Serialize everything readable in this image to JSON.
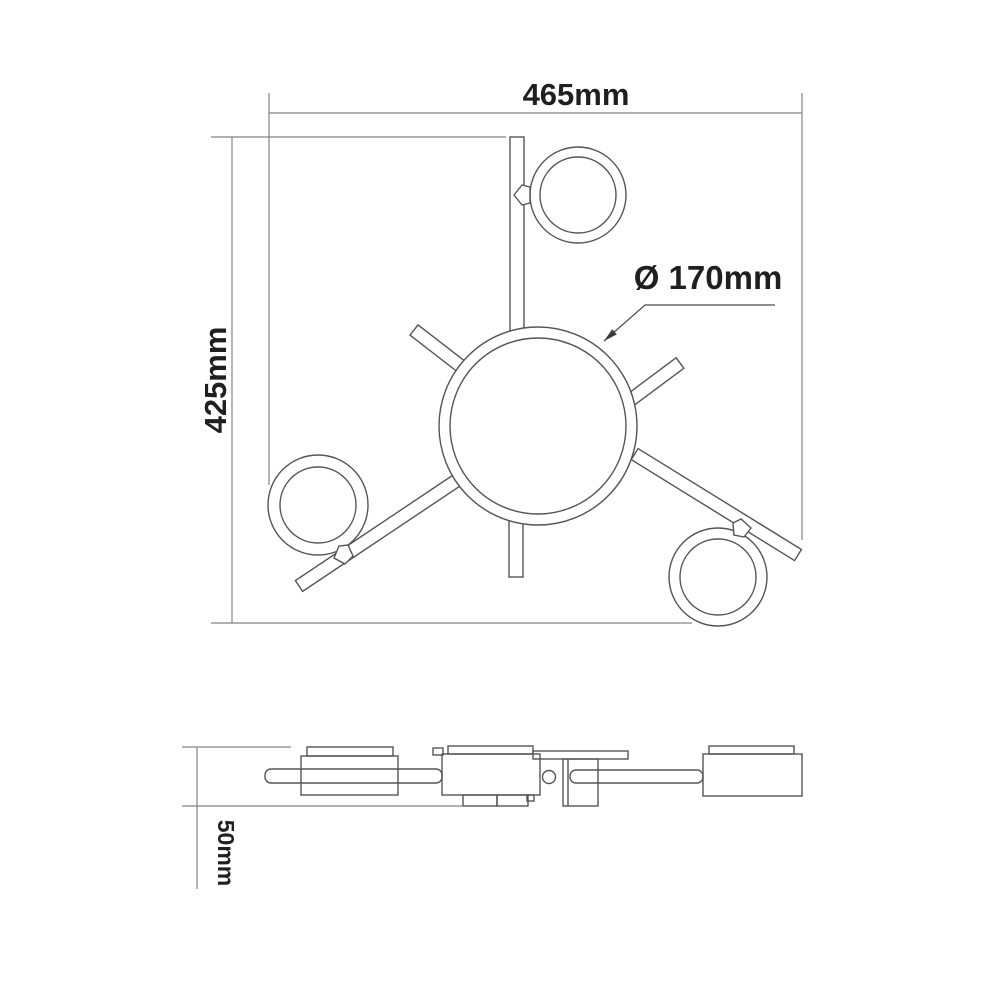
{
  "title": "ceiling-lamp-dimension-drawing",
  "colors": {
    "bg": "#ffffff",
    "line": "#555555",
    "dim": "#848484",
    "text": "#1f1f1f"
  },
  "top_view": {
    "width_label": "465mm",
    "height_label": "425mm",
    "diameter_label": "Ø 170mm"
  },
  "side_view": {
    "height_label": "50mm"
  }
}
